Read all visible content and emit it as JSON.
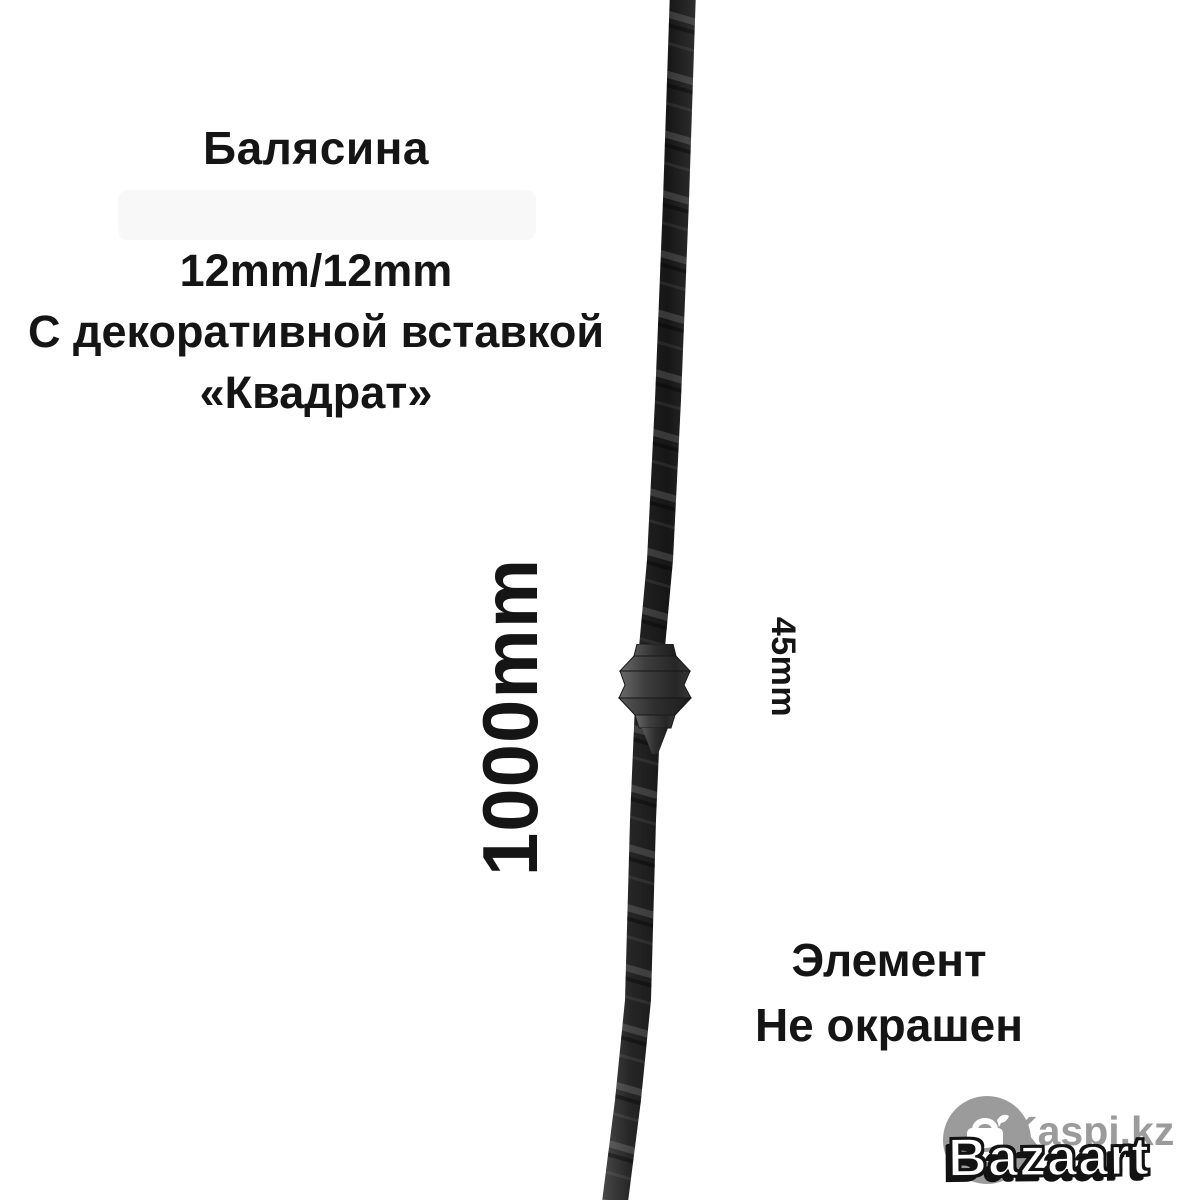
{
  "annotations": {
    "title": "Балясина",
    "specs": [
      "12mm/12mm",
      "С декоративной вставкой",
      "«Квадрат»"
    ],
    "height_dimension": "1000mm",
    "insert_dimension": "45mm",
    "finish_note": [
      "Элемент",
      "Не окрашен"
    ]
  },
  "product": {
    "subject": "twisted-square-baluster-rod-with-square-insert",
    "rod_color": "#232323",
    "insert_color": "#3f3f3f"
  },
  "watermarks": {
    "kaspi_label": "Kaspi.kz",
    "kaspi_icon": "kaspi-shopping-bag-icon",
    "seller_label": "Bazaart",
    "watermark_gray": "#9b9b9b"
  },
  "colors": {
    "background": "#ffffff",
    "text": "#151515"
  }
}
